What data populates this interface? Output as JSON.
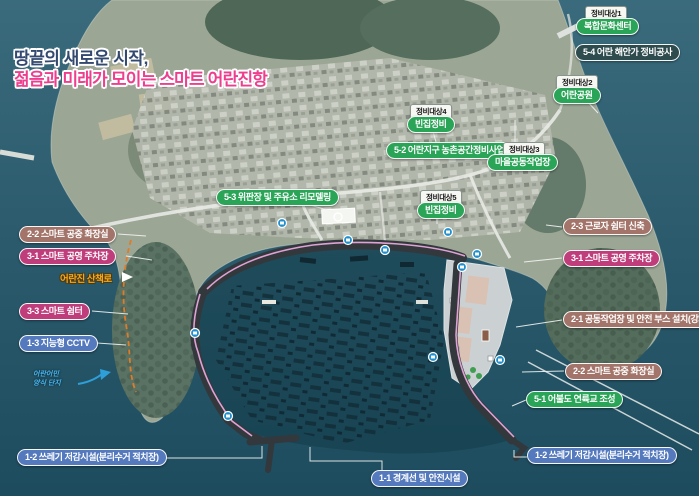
{
  "title": {
    "line1": "땅끝의 새로운 시작,",
    "line2": "젊음과 미래가 모이는 스마트 어란진항"
  },
  "tags": {
    "t1": "정비대상1",
    "t2": "정비대상2",
    "t3": "정비대상3",
    "t4": "정비대상4",
    "t5": "정비대상5"
  },
  "labels": {
    "complex_culture_center": "복합문화센터",
    "coast_repair": "5-4 어란 해안가 정비공사",
    "eoran_park": "어란공원",
    "empty_house_4": "빈집정비",
    "rural_space_project": "5-2 어란지구 농촌공간정비사업",
    "village_workshop": "마을공동작업장",
    "fish_market_remodel": "5-3 위판장 및 주유소 리모델링",
    "empty_house_5": "빈집정비",
    "worker_shelter": "2-3 근로자 쉼터 신축",
    "smart_parking_right": "3-1 스마트 공영 주차장",
    "smart_toilet_left": "2-2 스마트 공중 화장실",
    "smart_parking_left": "3-1 스마트 공영 주차장",
    "trail": "어란진 산책로",
    "smart_shelter": "3-3 스마트 쉼터",
    "smart_cctv": "1-3 지능형 CCTV",
    "note_line1": "어란어민",
    "note_line2": "양식 단지",
    "workshop_safety_booth": "2-1 공동작업장 및 안전 부스 설치(강화)",
    "smart_toilet_right": "2-2 스마트 공중 화장실",
    "island_bridge": "5-1 어불도 연륙교 조성",
    "waste_facility_left": "1-2 쓰레기 저감시설(분리수거 적치장)",
    "boundary_safety": "1-1 경계선 및 안전시설",
    "waste_facility_right": "1-2 쓰레기 저감시설(분리수거 적치장)"
  },
  "colors": {
    "project_green": "#2aa457",
    "smart_magenta": "#bf3d7b",
    "welfare_brown": "#a3756a",
    "safety_blue": "#5479bd",
    "coast_dark": "#2e4b4d",
    "trail_orange": "#e07b28",
    "note_blue": "#49b4ea",
    "title_navy": "#33496f",
    "title_pink": "#ee3f8e"
  }
}
